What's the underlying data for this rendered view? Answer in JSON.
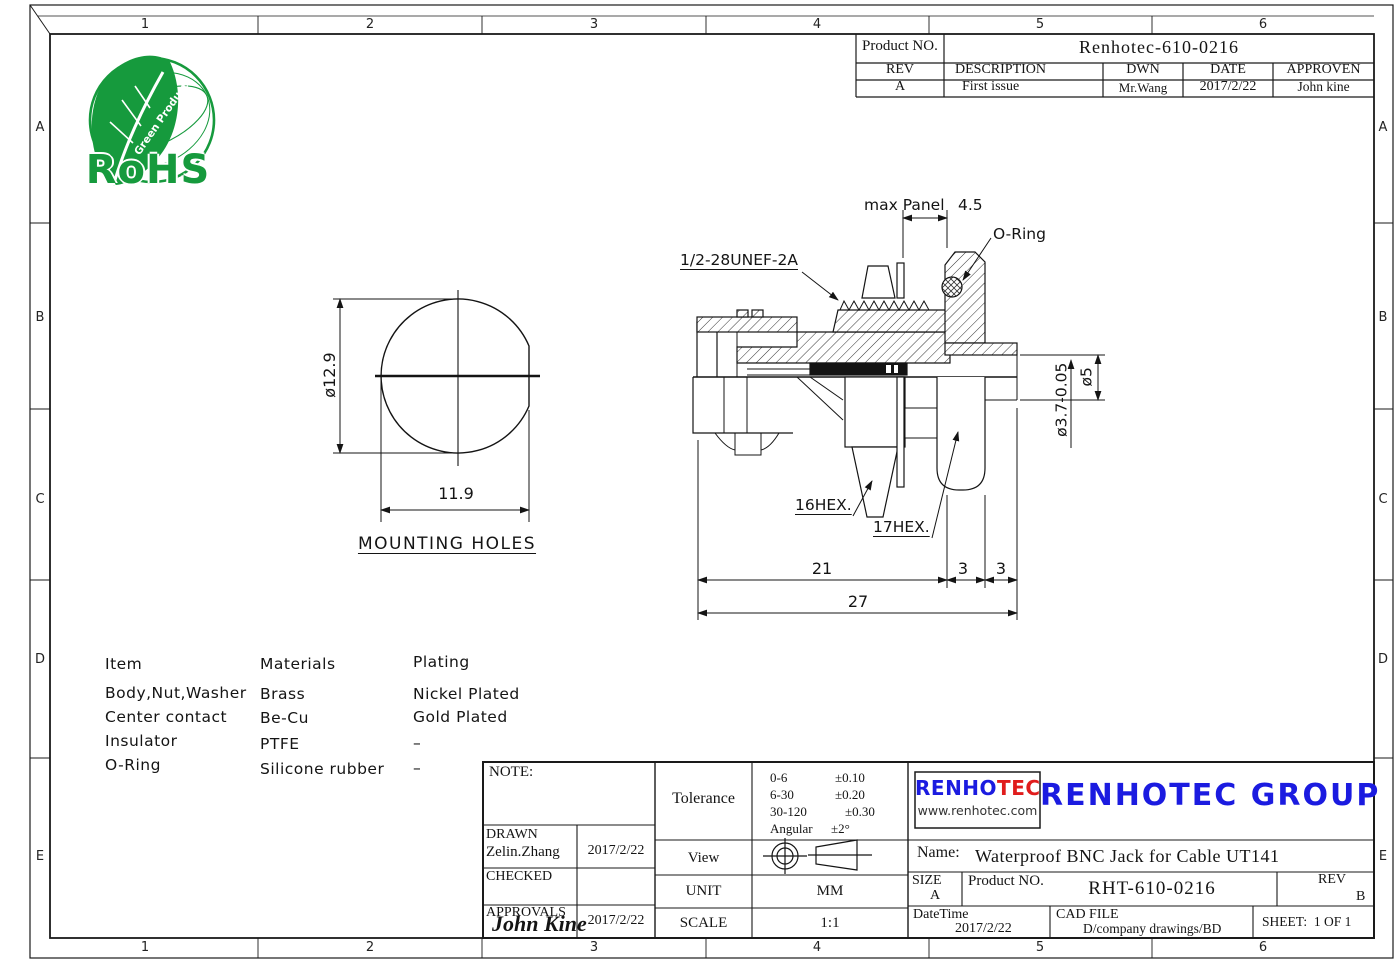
{
  "colors": {
    "line": "#1a1a1a",
    "logo_green": "#169a3d",
    "brand_blue": "#1b1be0",
    "brand_red": "#e01c1c"
  },
  "frame": {
    "top_zones": [
      "1",
      "2",
      "3",
      "4",
      "5",
      "6"
    ],
    "side_zones": [
      "A",
      "B",
      "C",
      "D",
      "E"
    ]
  },
  "rohs_logo": {
    "text": "RoHS",
    "leaf_text": "Green Product"
  },
  "revision_table": {
    "product_label": "Product NO.",
    "product_value": "Renhotec-610-0216",
    "headers": [
      "REV",
      "DESCRIPTION",
      "DWN",
      "DATE",
      "APPROVEN"
    ],
    "row": [
      "A",
      "First issue",
      "Mr.Wang",
      "2017/2/22",
      "John kine"
    ]
  },
  "mounting_view": {
    "title": "MOUNTING HOLES",
    "dim_diameter": "ø12.9",
    "dim_width": "11.9"
  },
  "section_view": {
    "labels": {
      "thread": "1/2-28UNEF-2A",
      "max_panel": "max Panel",
      "max_panel_value": "4.5",
      "oring": "O-Ring",
      "hex16": "16HEX.",
      "hex17": "17HEX."
    },
    "dims": {
      "d21": "21",
      "d3a": "3",
      "d3b": "3",
      "d27": "27",
      "dia5": "ø5",
      "dia37": "ø3.7-0.05"
    }
  },
  "materials_table": {
    "headers": [
      "Item",
      "Materials",
      "Plating"
    ],
    "rows": [
      [
        "Body,Nut,Washer",
        "Brass",
        "Nickel Plated"
      ],
      [
        "Center contact",
        "Be-Cu",
        "Gold Plated"
      ],
      [
        "Insulator",
        "PTFE",
        "–"
      ],
      [
        "O-Ring",
        "Silicone rubber",
        "–"
      ]
    ]
  },
  "title_block": {
    "note_label": "NOTE:",
    "drawn_label": "DRAWN",
    "drawn_name": "Zelin.Zhang",
    "drawn_date": "2017/2/22",
    "checked_label": "CHECKED",
    "approvals_label": "APPROVALS",
    "approvals_sign": "John Kine",
    "approvals_date": "2017/2/22",
    "tolerance_label": "Tolerance",
    "tolerance_rows": [
      [
        "0-6",
        "±0.10"
      ],
      [
        "6-30",
        "±0.20"
      ],
      [
        "30-120",
        "±0.30"
      ],
      [
        "Angular",
        "±2°"
      ]
    ],
    "view_label": "View",
    "unit_label": "UNIT",
    "unit_value": "MM",
    "scale_label": "SCALE",
    "scale_value": "1:1",
    "logo_part1": "RENHO",
    "logo_part2": "TEC",
    "logo_url": "www.renhotec.com",
    "company": "RENHOTEC GROUP",
    "name_label": "Name:",
    "name_value": "Waterproof BNC Jack for Cable UT141",
    "size_label": "SIZE",
    "size_value": "A",
    "product_label": "Product NO.",
    "product_value": "RHT-610-0216",
    "rev_label": "REV",
    "rev_value": "B",
    "datetime_label": "DateTime",
    "datetime_value": "2017/2/22",
    "cadfile_label": "CAD FILE",
    "cadfile_value": "D/company drawings/BD",
    "sheet_label": "SHEET:",
    "sheet_value": "1 OF 1"
  }
}
